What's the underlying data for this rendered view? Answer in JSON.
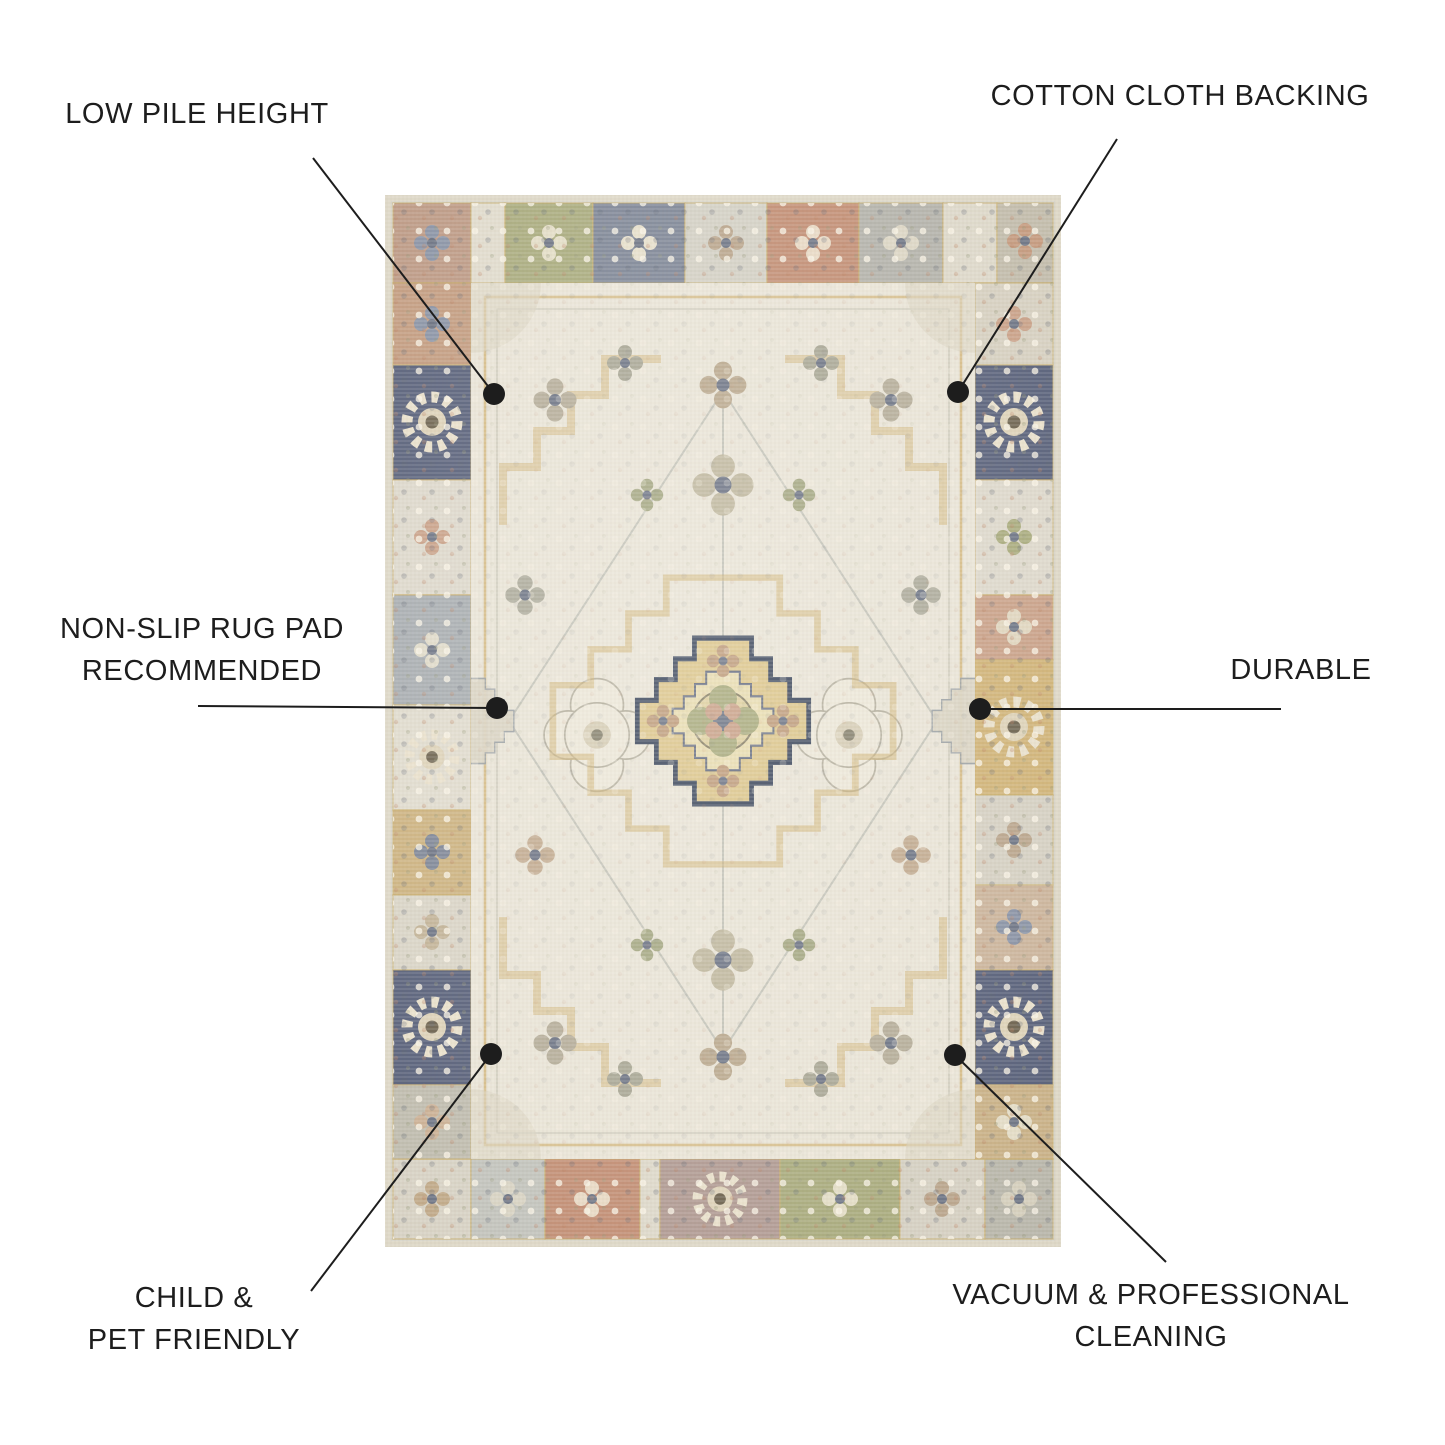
{
  "page": {
    "title": "Rug feature infographic",
    "product_alt": "Distressed vintage-style medallion area rug in ivory, gold, rust, green and navy patchwork"
  },
  "palette": {
    "page-bg": "#ffffff",
    "text-ink": "#1d1d1d",
    "leader-ink": "#1d1d1d",
    "rug-edge": "#ddd7c6",
    "rug-border-base": "#d6d3c7",
    "rug-field": "#e9e4d6",
    "gold": "#cfb274",
    "navy": "#59617a",
    "rust": "#c28e74",
    "green": "#a9ab7d",
    "greyblue": "#a8adb0",
    "mauve": "#b09a92"
  },
  "callouts": [
    {
      "id": "low-pile-height",
      "lines": [
        "LOW PILE HEIGHT"
      ],
      "dot": {
        "x": 494,
        "y": 394
      },
      "leader": {
        "x1": 313,
        "y1": 158,
        "x2": 494,
        "y2": 394
      }
    },
    {
      "id": "cotton-cloth-backing",
      "lines": [
        "COTTON CLOTH BACKING"
      ],
      "dot": {
        "x": 958,
        "y": 392
      },
      "leader": {
        "x1": 1117,
        "y1": 139,
        "x2": 958,
        "y2": 392
      }
    },
    {
      "id": "non-slip-rug-pad-recommended",
      "lines": [
        "NON-SLIP RUG PAD",
        "RECOMMENDED"
      ],
      "dot": {
        "x": 497,
        "y": 708
      },
      "leader": {
        "x1": 198,
        "y1": 706,
        "x2": 497,
        "y2": 708
      }
    },
    {
      "id": "durable",
      "lines": [
        "DURABLE"
      ],
      "dot": {
        "x": 980,
        "y": 709
      },
      "leader": {
        "x1": 1281,
        "y1": 709,
        "x2": 980,
        "y2": 709
      }
    },
    {
      "id": "child-pet-friendly",
      "lines": [
        "CHILD &",
        "PET FRIENDLY"
      ],
      "dot": {
        "x": 491,
        "y": 1054
      },
      "leader": {
        "x1": 311,
        "y1": 1291,
        "x2": 491,
        "y2": 1054
      }
    },
    {
      "id": "vacuum-professional-cleaning",
      "lines": [
        "VACUUM & PROFESSIONAL",
        "CLEANING"
      ],
      "dot": {
        "x": 955,
        "y": 1055
      },
      "leader": {
        "x1": 1166,
        "y1": 1262,
        "x2": 955,
        "y2": 1055
      }
    }
  ]
}
